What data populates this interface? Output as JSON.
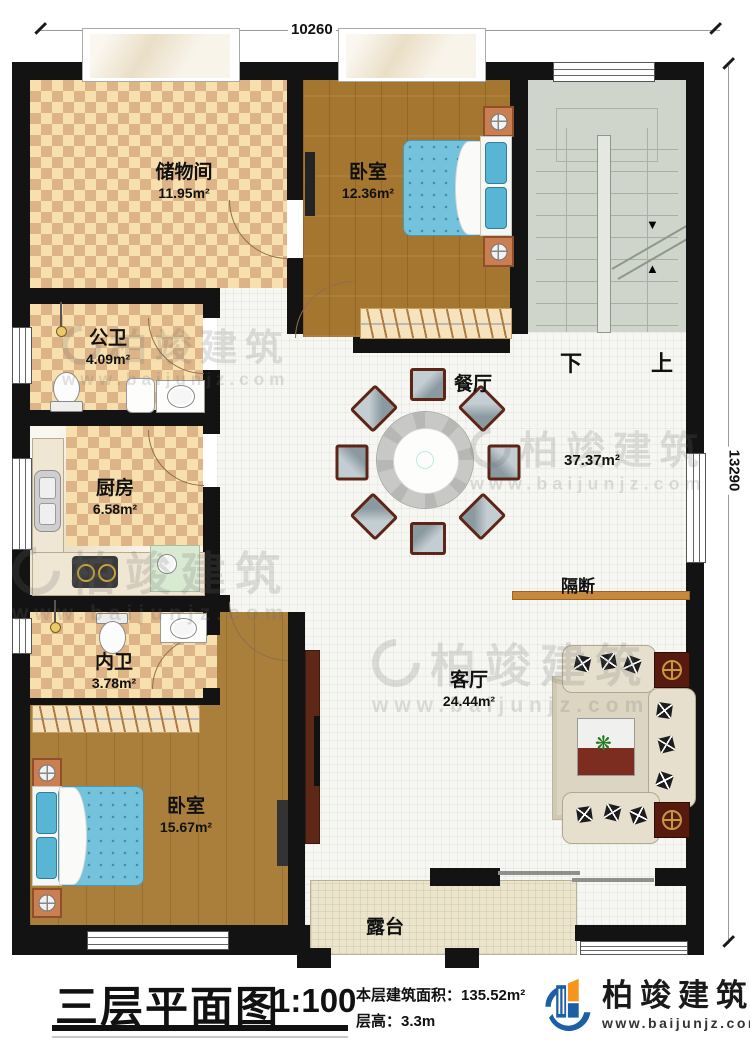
{
  "dimensions": {
    "top": "10260",
    "right": "13290"
  },
  "rooms": {
    "storage": {
      "name": "储物间",
      "area": "11.95m²"
    },
    "bedroom_top": {
      "name": "卧室",
      "area": "12.36m²"
    },
    "public_bath": {
      "name": "公卫",
      "area": "4.09m²"
    },
    "kitchen": {
      "name": "厨房",
      "area": "6.58m²"
    },
    "inner_bath": {
      "name": "内卫",
      "area": "3.78m²"
    },
    "bedroom_bottom": {
      "name": "卧室",
      "area": "15.67m²"
    },
    "dining": {
      "name": "餐厅"
    },
    "living": {
      "name": "客厅",
      "area": "24.44m²"
    },
    "terrace": {
      "name": "露台"
    },
    "hall_area": "37.37m²",
    "partition": "隔断"
  },
  "stairs": {
    "down": "下",
    "up": "上"
  },
  "titlebar": {
    "plan_title": "三层平面图",
    "scale": "1:100",
    "floor_area_label": "本层建筑面积：",
    "floor_area_value": "135.52m²",
    "floor_height_label": "层高：",
    "floor_height_value": "3.3m"
  },
  "brand": {
    "company": "柏竣建筑",
    "website": "www.baijunjz.com"
  },
  "watermark": {
    "company": "柏竣建筑",
    "website": "www.baijunjz.com"
  }
}
